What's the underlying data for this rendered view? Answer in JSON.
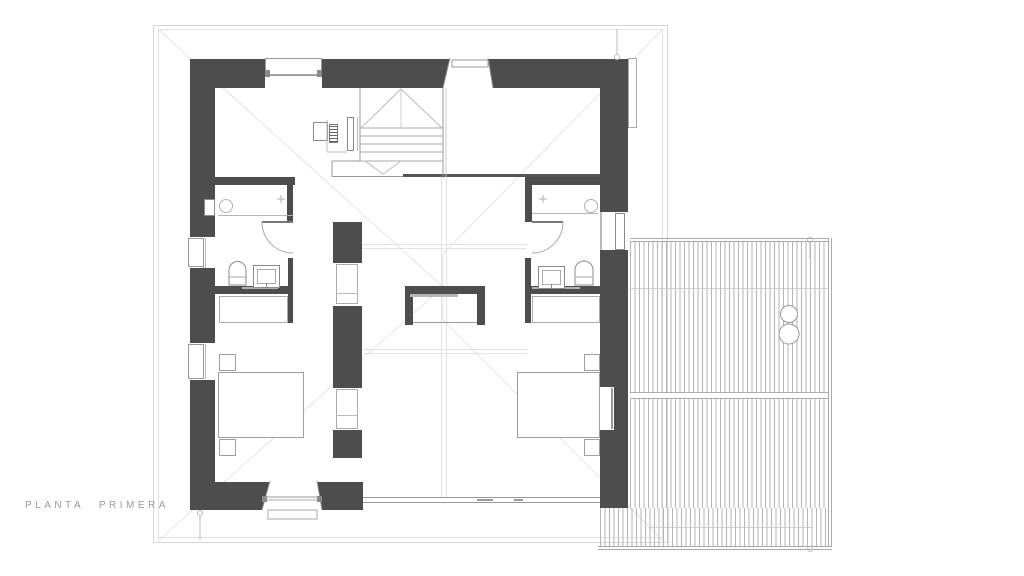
{
  "drawing": {
    "label": "PLANTA PRIMERA"
  },
  "colors": {
    "background": "#ffffff",
    "wall": "#4d4d4d",
    "line_mid": "#999999",
    "line_soft": "#aaaaaa",
    "line_light": "#e2e2e2",
    "deck_line": "#b5b5b5",
    "frame": "#d5d5d5",
    "label_text": "#9b9b9b"
  }
}
